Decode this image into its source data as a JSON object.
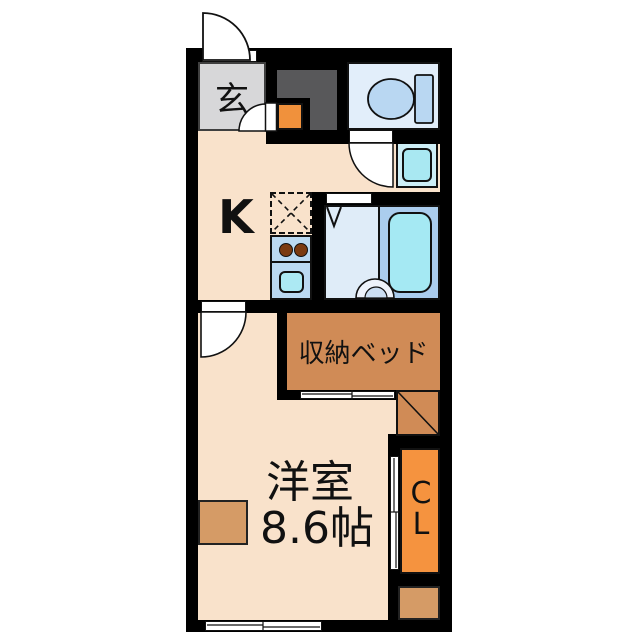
{
  "title": "apartment-floor-plan",
  "rooms": {
    "entrance": {
      "label": "玄"
    },
    "kitchen": {
      "label": "K"
    },
    "storage_bed": {
      "label": "収納ベッド"
    },
    "western_room": {
      "label": "洋室",
      "size": "8.6帖"
    },
    "closet": {
      "label": "CL"
    }
  },
  "colors": {
    "wall": "#000000",
    "floor": "#f9e2cb",
    "entrance_gray": "#d7d7d9",
    "dark_gray": "#58585a",
    "step_orange": "#f0913c",
    "toilet_floor": "#e2eefa",
    "fixture_blue": "#b9d7f2",
    "water_cyan": "#a5e9f3",
    "appliance_blue": "#bbd9f1",
    "bath_floor": "#dfecf8",
    "tub_surround": "#abcdee",
    "bed_brown": "#d08b56",
    "closet_orange": "#f5933f",
    "tan": "#d59b66"
  },
  "fixtures": [
    "entry-door",
    "toilet",
    "washing-machine",
    "bathtub",
    "wash-basin",
    "folding-door",
    "kitchen-stove",
    "kitchen-sink",
    "refrigerator-space",
    "sliding-door",
    "window",
    "swing-door"
  ]
}
